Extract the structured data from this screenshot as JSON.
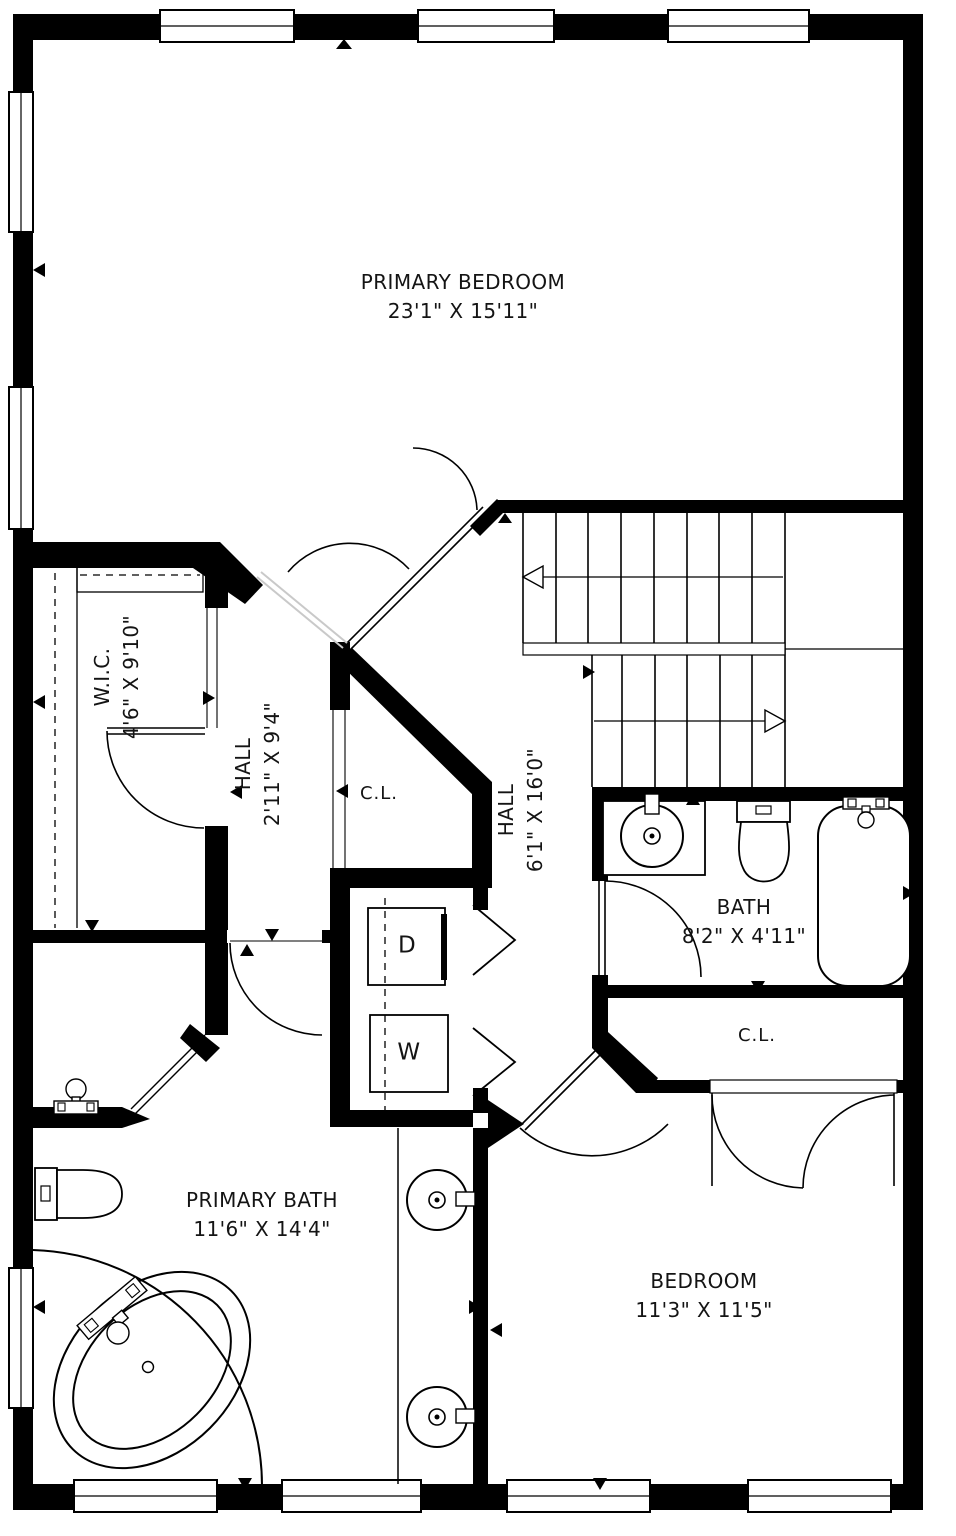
{
  "title": "Second floor plan",
  "colors": {
    "wall": "#000000",
    "floor": "#ffffff",
    "line": "#000000",
    "open_door_gray": "#c9c9c9"
  },
  "rooms": {
    "primary_bedroom": {
      "name": "PRIMARY BEDROOM",
      "dims": "23'1\" X 15'11\""
    },
    "wic": {
      "name": "W.I.C.",
      "dims": "4'6\" X 9'10\""
    },
    "hall_small": {
      "name": "HALL",
      "dims": "2'11\" X 9'4\""
    },
    "closet_hall": {
      "name": "C.L."
    },
    "hall_main": {
      "name": "HALL",
      "dims": "6'1\" X 16'0\""
    },
    "bath": {
      "name": "BATH",
      "dims": "8'2\" X 4'11\""
    },
    "closet_bedroom": {
      "name": "C.L."
    },
    "primary_bath": {
      "name": "PRIMARY BATH",
      "dims": "11'6\" X 14'4\""
    },
    "bedroom": {
      "name": "BEDROOM",
      "dims": "11'3\" X 11'5\""
    }
  },
  "appliances": {
    "dryer": "D",
    "washer": "W"
  }
}
